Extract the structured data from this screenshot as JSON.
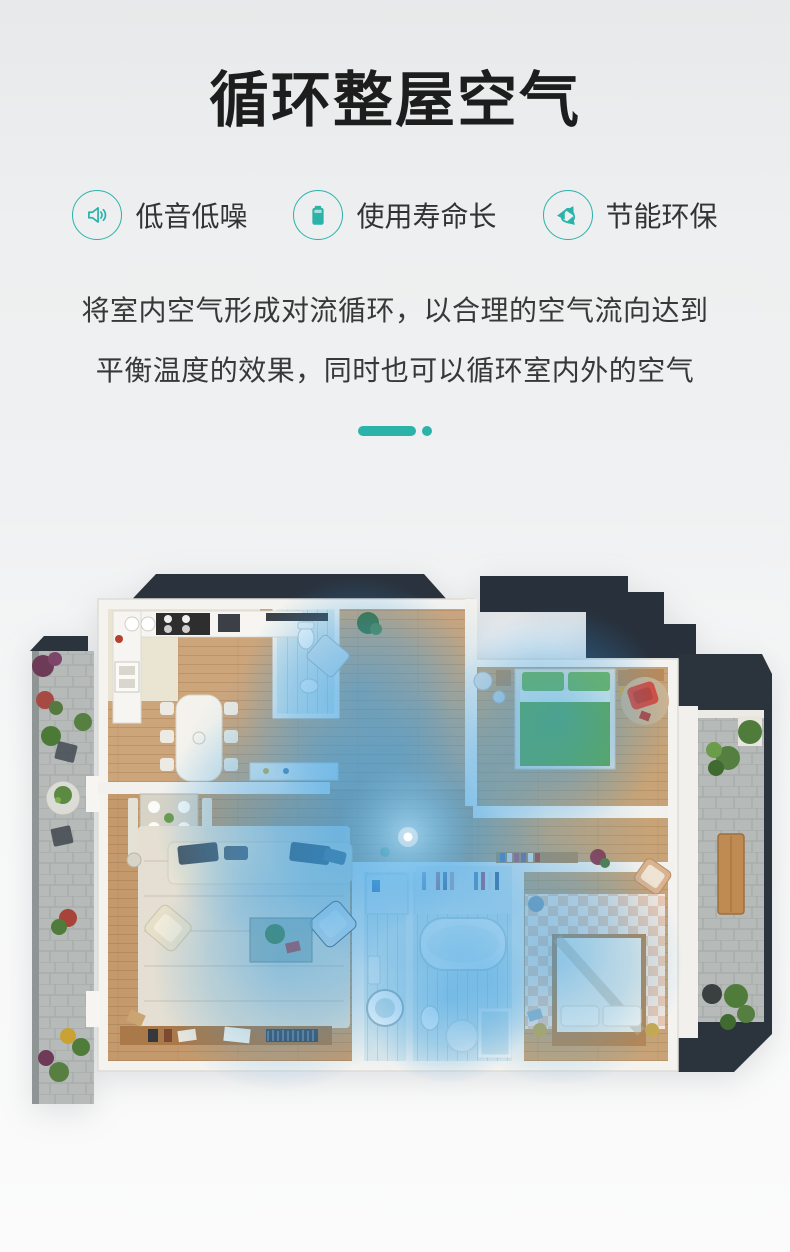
{
  "accent": "#2bb3a9",
  "header": {
    "title": "循环整屋空气"
  },
  "features": [
    {
      "icon": "speaker-icon",
      "label": "低音低噪"
    },
    {
      "icon": "battery-icon",
      "label": "使用寿命长"
    },
    {
      "icon": "recycle-icon",
      "label": "节能环保"
    }
  ],
  "description": {
    "line1": "将室内空气形成对流循环，以合理的空气流向达到",
    "line2": "平衡温度的效果，同时也可以循环室内外的空气"
  },
  "floorplan": {
    "type": "apartment-top-view-illustration",
    "airflow_color": "#2f9ce4",
    "device_marker": "white-dot-center",
    "palette": {
      "roof": "#2a323d",
      "walls": "#f4f3f0",
      "wood_floor": "#c9a174",
      "bathroom_floor": "#d9e7ea",
      "terrace": "#b6bab9",
      "bed_green": "#6fae3e",
      "accent_red": "#d84b3c"
    }
  }
}
